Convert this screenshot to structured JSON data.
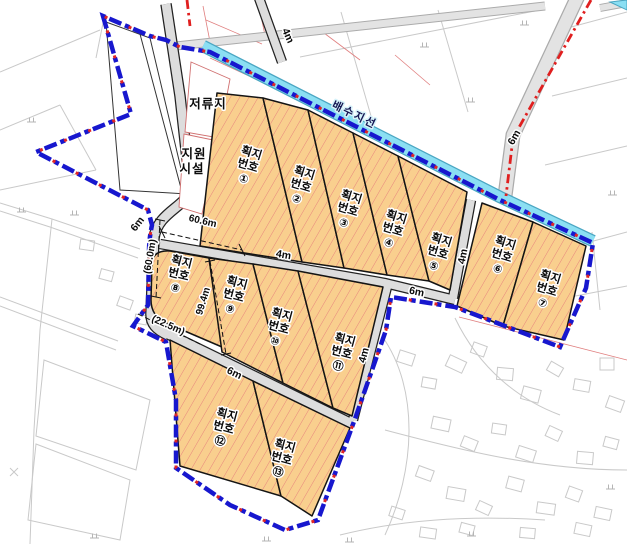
{
  "map_title": "획지 배치 계획도",
  "labels": {
    "detention_pond": "저류지",
    "support_facility_line1": "지원",
    "support_facility_line2": "시설",
    "drainage_branch": "배수지선",
    "parcel_line1": "획지",
    "parcel_line2": "번호"
  },
  "parcels": [
    {
      "num": "①"
    },
    {
      "num": "②"
    },
    {
      "num": "③"
    },
    {
      "num": "④"
    },
    {
      "num": "⑤"
    },
    {
      "num": "⑥"
    },
    {
      "num": "⑦"
    },
    {
      "num": "⑧"
    },
    {
      "num": "⑨"
    },
    {
      "num": "⑩"
    },
    {
      "num": "⑪"
    },
    {
      "num": "⑫"
    },
    {
      "num": "⑬"
    }
  ],
  "road_labels": [
    {
      "id": "road-4m-top",
      "text": "4m"
    },
    {
      "id": "road-4m-middle",
      "text": "4m"
    },
    {
      "id": "road-4m-vertical",
      "text": "4m"
    },
    {
      "id": "road-4m-right",
      "text": "4m"
    },
    {
      "id": "road-6m-left",
      "text": "6m"
    },
    {
      "id": "road-6m-northeast",
      "text": "6m"
    },
    {
      "id": "road-6m-bottom",
      "text": "6m"
    },
    {
      "id": "road-6m-rightmid",
      "text": "6m"
    }
  ],
  "dimensions": [
    {
      "id": "dim-top",
      "text": "60.6m"
    },
    {
      "id": "dim-left",
      "text": "(60.0m)"
    },
    {
      "id": "dim-right",
      "text": "99.4m"
    },
    {
      "id": "dim-bottom",
      "text": "(22.5m)"
    }
  ],
  "colors": {
    "parcel_fill": "#F9CF8E",
    "parcel_hatch": "#E7857D",
    "parcel_border": "#141414",
    "site_boundary_blue": "#1717CE",
    "boundary_red_accent": "#E02525",
    "road_red_line": "#E01F1F",
    "channel_fill": "#8BDFF3",
    "road_fill": "#DDDDDD",
    "cadastral_gray": "#C9C9C9"
  }
}
